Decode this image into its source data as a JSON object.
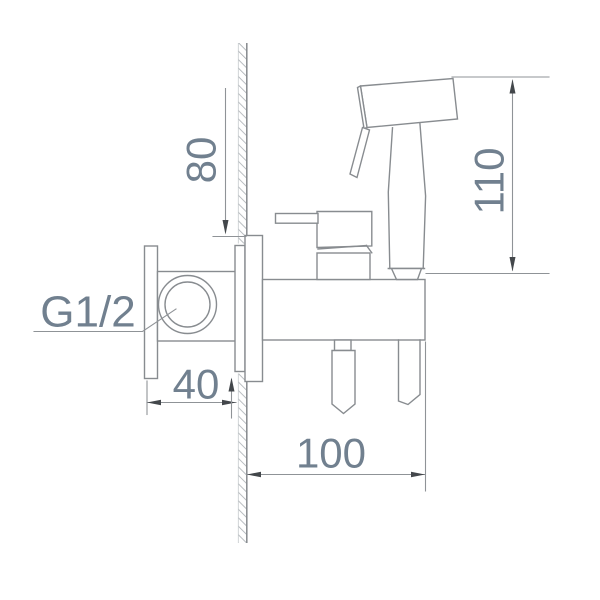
{
  "dimensions": {
    "d80": "80",
    "d110": "110",
    "d40": "40",
    "d100": "100"
  },
  "labels": {
    "thread": "G1/2"
  },
  "colors": {
    "object_line": "#888c90",
    "dimension_line": "#8f9397",
    "text": "#71808f",
    "arrowhead": "#43474b",
    "wall_hatch": "#a9aeb2",
    "background": "#ffffff"
  }
}
